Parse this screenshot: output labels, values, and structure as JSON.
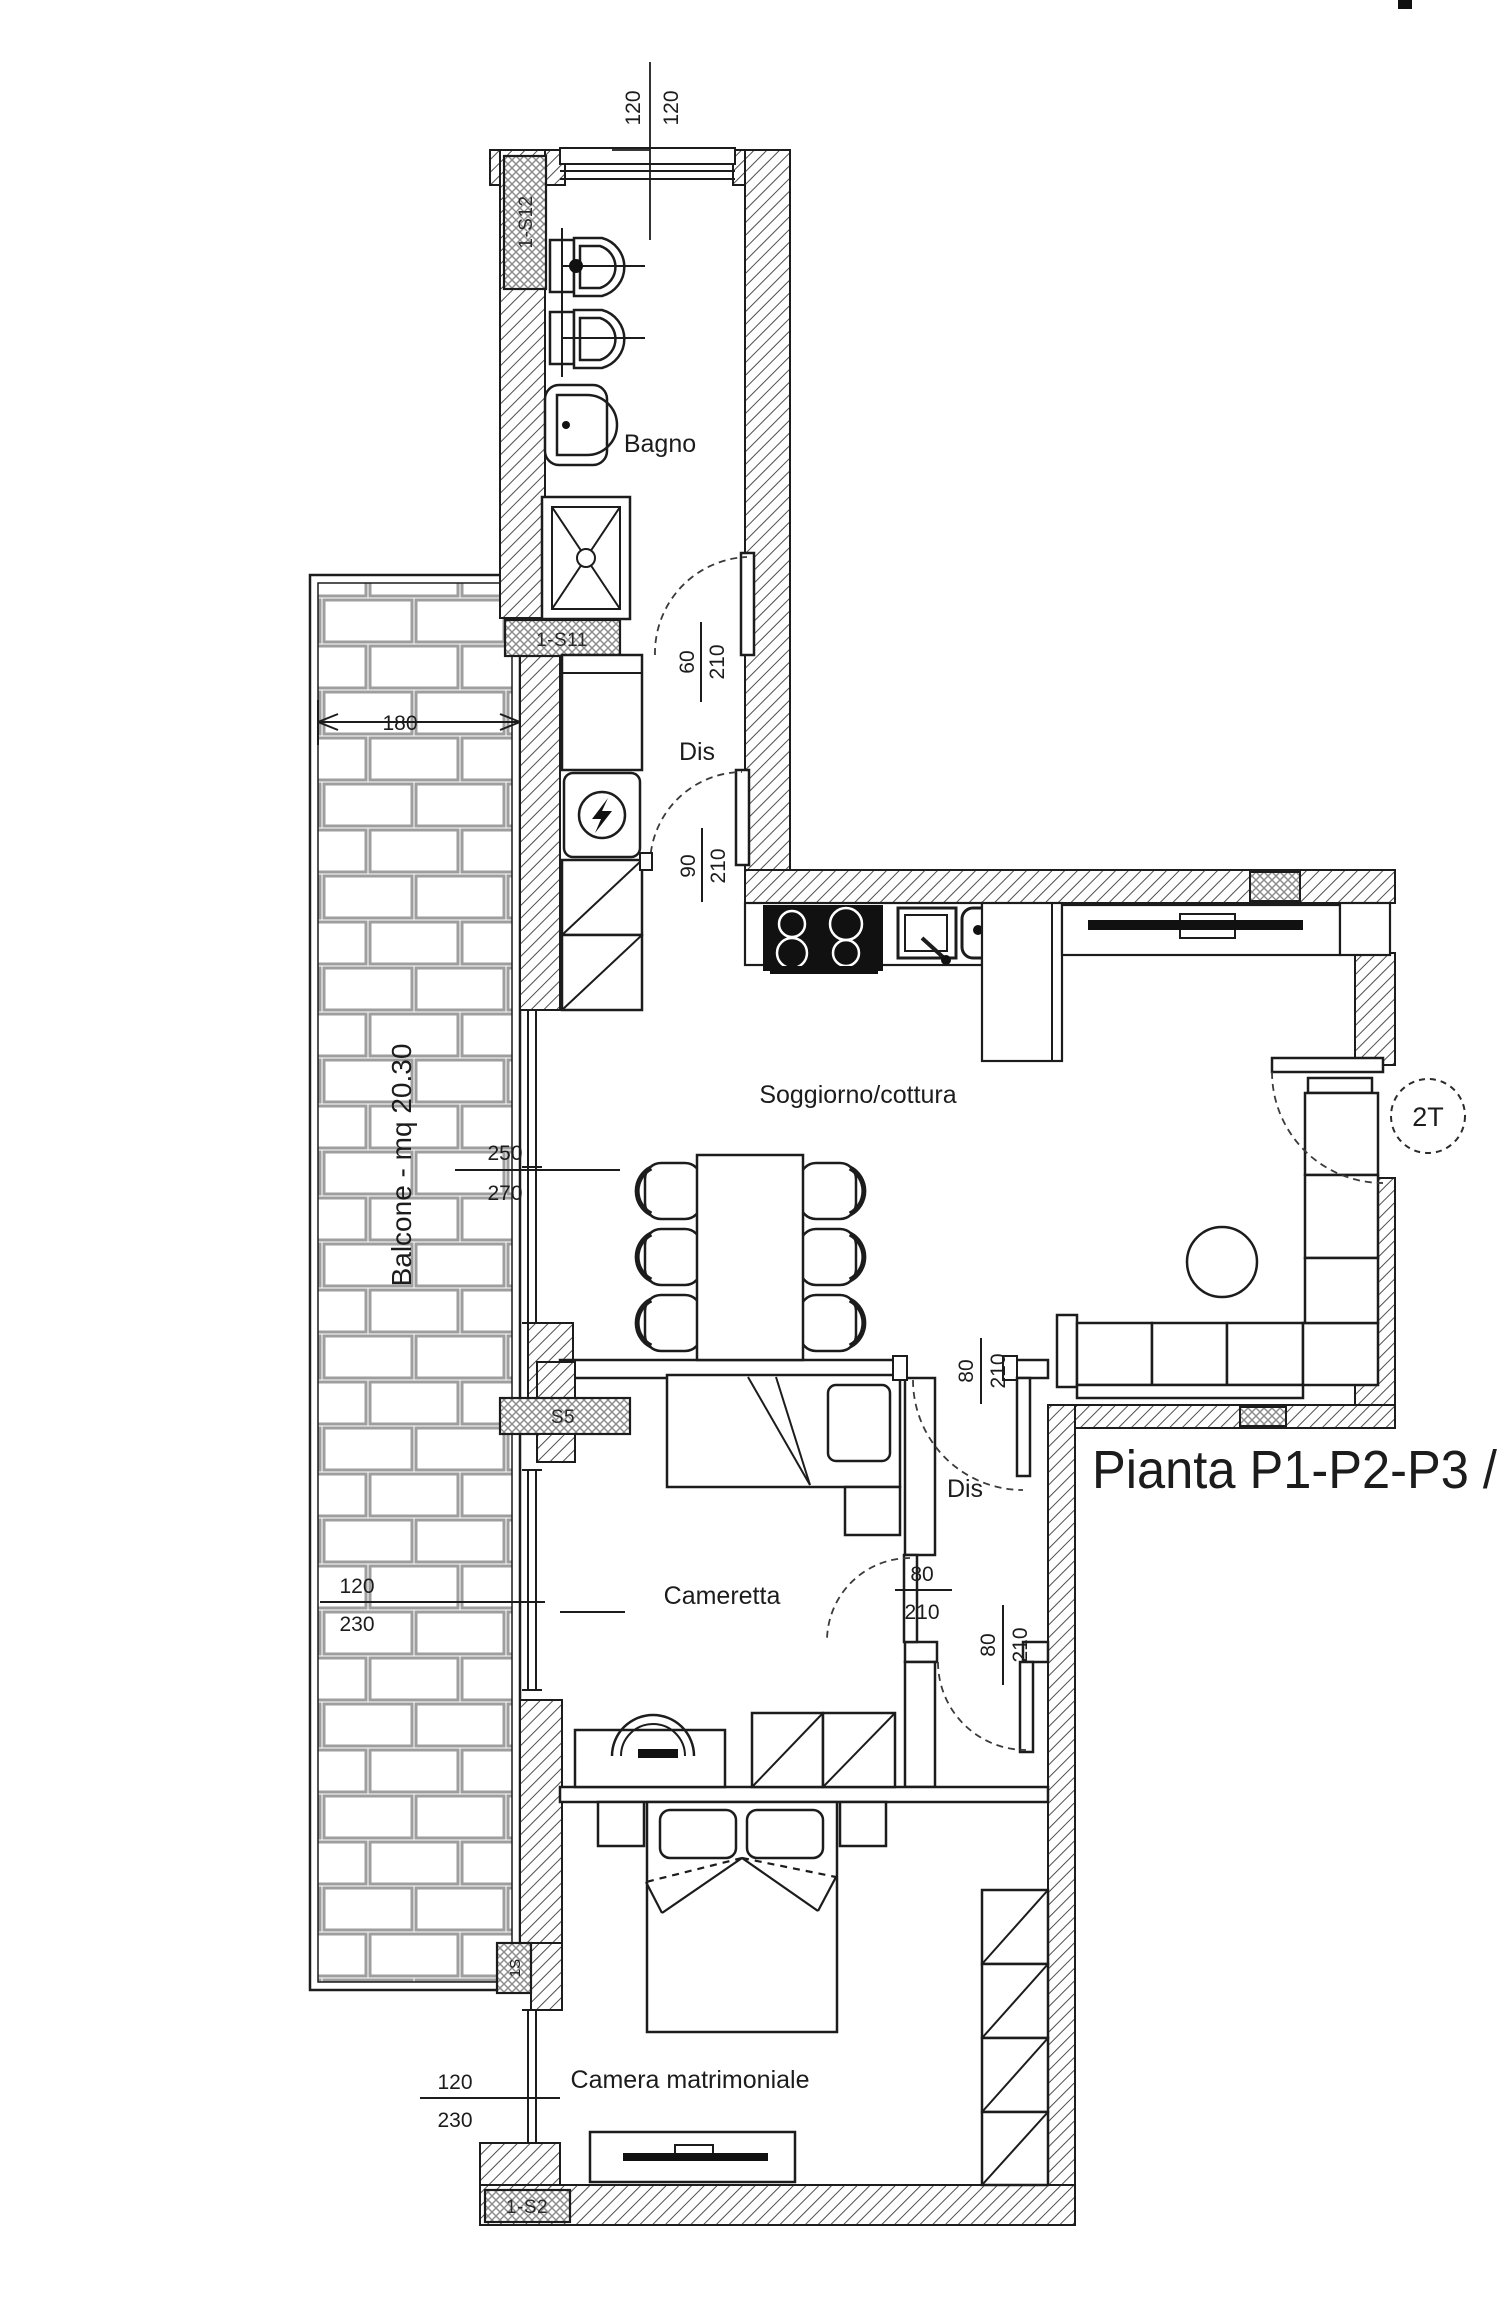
{
  "plan": {
    "title": "Pianta P1-P2-P3 /",
    "rooms": {
      "bagno": "Bagno",
      "dis_top": "Dis",
      "soggiorno": "Soggiorno/cottura",
      "dis_mid": "Dis",
      "cameretta": "Cameretta",
      "camera_matrimoniale": "Camera matrimoniale",
      "balcone": "Balcone - mq 20.30"
    },
    "stair_label": "2T",
    "wall_tags": {
      "tag_s12": "1-S12",
      "tag_s11": "1-S11",
      "tag_s5": "S5",
      "tag_s1": "1S",
      "tag_s2": "1-S2"
    },
    "dims": {
      "top_window_left": "120",
      "top_window_right": "120",
      "balcone_width": "180",
      "bagno_door_w": "60",
      "bagno_door_h": "210",
      "dis_door_w": "90",
      "dis_door_h": "210",
      "sogg_window_w": "250",
      "sogg_window_h": "270",
      "cameretta_window_w": "120",
      "cameretta_window_h": "230",
      "camera_window_w": "120",
      "camera_window_h": "230",
      "sogg_dis_door_w": "80",
      "sogg_dis_door_h": "210",
      "dis_cameretta_door_w": "80",
      "dis_cameretta_door_h": "210",
      "dis_camera_door_w": "80",
      "dis_camera_door_h": "210"
    }
  }
}
